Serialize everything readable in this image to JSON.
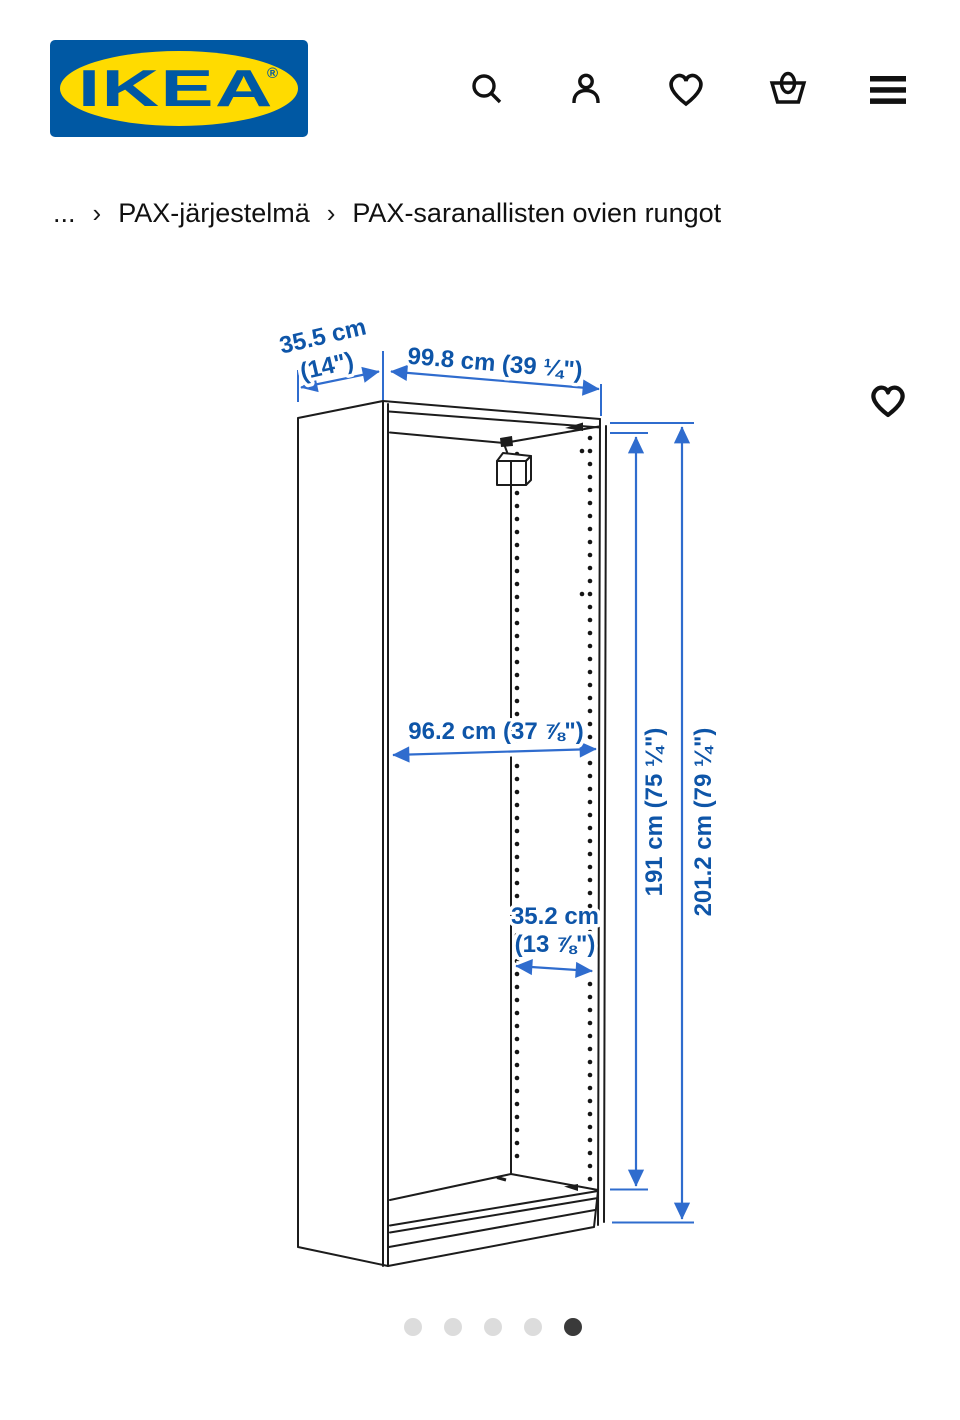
{
  "header": {
    "logo_text": "IKEA",
    "logo_registered": "®",
    "logo_colors": {
      "background": "#0058a3",
      "ellipse": "#ffdb00",
      "text": "#0058a3"
    },
    "icons": [
      "search-icon",
      "profile-icon",
      "favorites-icon",
      "basket-icon",
      "menu-icon"
    ]
  },
  "breadcrumb": {
    "separator": "›",
    "items": [
      "...",
      "PAX-järjestelmä",
      "PAX-saranallisten ovien rungot"
    ]
  },
  "figure": {
    "description": "PAX wardrobe frame dimensional line drawing",
    "favorite_icon": "heart-icon",
    "colors": {
      "dim_line": "#2f6cce",
      "dim_text": "#0e55a8",
      "drawing_line": "#1c1c1c"
    },
    "labels": {
      "depth_cm": "35.5 cm",
      "depth_in": "(14\")",
      "width": "99.8 cm (39 ¼\")",
      "inner_width": "96.2 cm (37 ⅞\")",
      "inner_depth_cm": "35.2 cm",
      "inner_depth_in": "(13 ⅞\")",
      "inner_height": "191 cm (75 ¼\")",
      "outer_height": "201.2 cm (79 ¼\")"
    }
  },
  "carousel": {
    "count": 5,
    "active_index": 4
  }
}
